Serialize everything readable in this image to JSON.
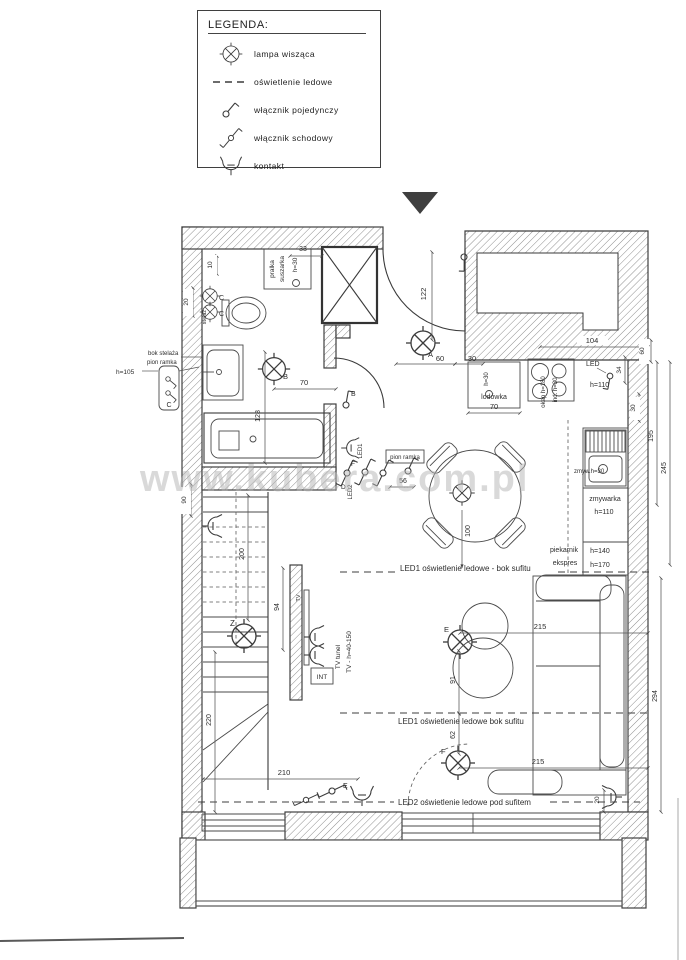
{
  "legend": {
    "title": "LEGENDA:",
    "items": [
      {
        "icon": "pendant-lamp-icon",
        "label": "lampa wisząca"
      },
      {
        "icon": "led-strip-icon",
        "label": "oświetlenie ledowe"
      },
      {
        "icon": "single-switch-icon",
        "label": "włącznik pojedynczy"
      },
      {
        "icon": "stair-switch-icon",
        "label": "włącznik schodowy"
      },
      {
        "icon": "socket-icon",
        "label": "kontakt"
      }
    ]
  },
  "watermark": "www.kubera.com.pl",
  "fixtures": {
    "pralka_line1": "pralka",
    "pralka_line2": "suszarka",
    "pralka_h": "h=30",
    "lodowka": "lodówka",
    "lodowka_socket_h": "h=30",
    "okap": "okap h=180",
    "indukcja": "ind. h=30",
    "led_switch": "LED",
    "led_switch_h": "h=110",
    "zlew": "zmyw.h=30",
    "zmywarka": "zmywarka",
    "zmywarka_h": "h=110",
    "piekarnik": "piekarnik",
    "piekarnik_h": "h=140",
    "ekspres": "ekspres",
    "ekspres_h": "h=170",
    "stelaz": "stelaż",
    "bok_stelaza": "bok stelaża",
    "pion_ramka_bathroom": "pion ramka",
    "stelaz_h": "h=105",
    "pion_ramka_hall": "pion ramka",
    "tv": "TV",
    "tv_int": "INT",
    "tv_tunel": "TV tunel",
    "tv_h": "TV - h=40-150",
    "led1_label": "LED1",
    "led2_label": "LED2"
  },
  "led_lines": {
    "line1": "LED1 oświetlenie ledowe - bok sufitu",
    "line2": "LED1 oświetlenie ledowe bok sufitu",
    "line3": "LED2 oświetlenie ledowe pod sufitem"
  },
  "lamp_labels": {
    "a": "A",
    "b": "B",
    "c1": "C",
    "c2": "C",
    "z": "Z",
    "e": "E",
    "f": "F"
  },
  "switch_labels": {
    "b": "B",
    "c": "C",
    "d": "D",
    "e": "E",
    "f": "F"
  },
  "dims": {
    "d33": "33",
    "d10": "10",
    "d20": "20",
    "d90": "90",
    "d122": "122",
    "d60": "60",
    "d30": "30",
    "d70_fridge": "70",
    "d104": "104",
    "d60_wall": "60",
    "d34": "34",
    "d30_wall": "30",
    "d195": "195",
    "d245": "245",
    "d70_bath": "70",
    "d128": "128",
    "d100": "100",
    "d56": "56",
    "d200": "200",
    "d94": "94",
    "d220": "220",
    "d210": "210",
    "d215_top": "215",
    "d91": "91",
    "d62": "62",
    "d215_bottom": "215",
    "d294": "294",
    "d20_wall": "20"
  }
}
